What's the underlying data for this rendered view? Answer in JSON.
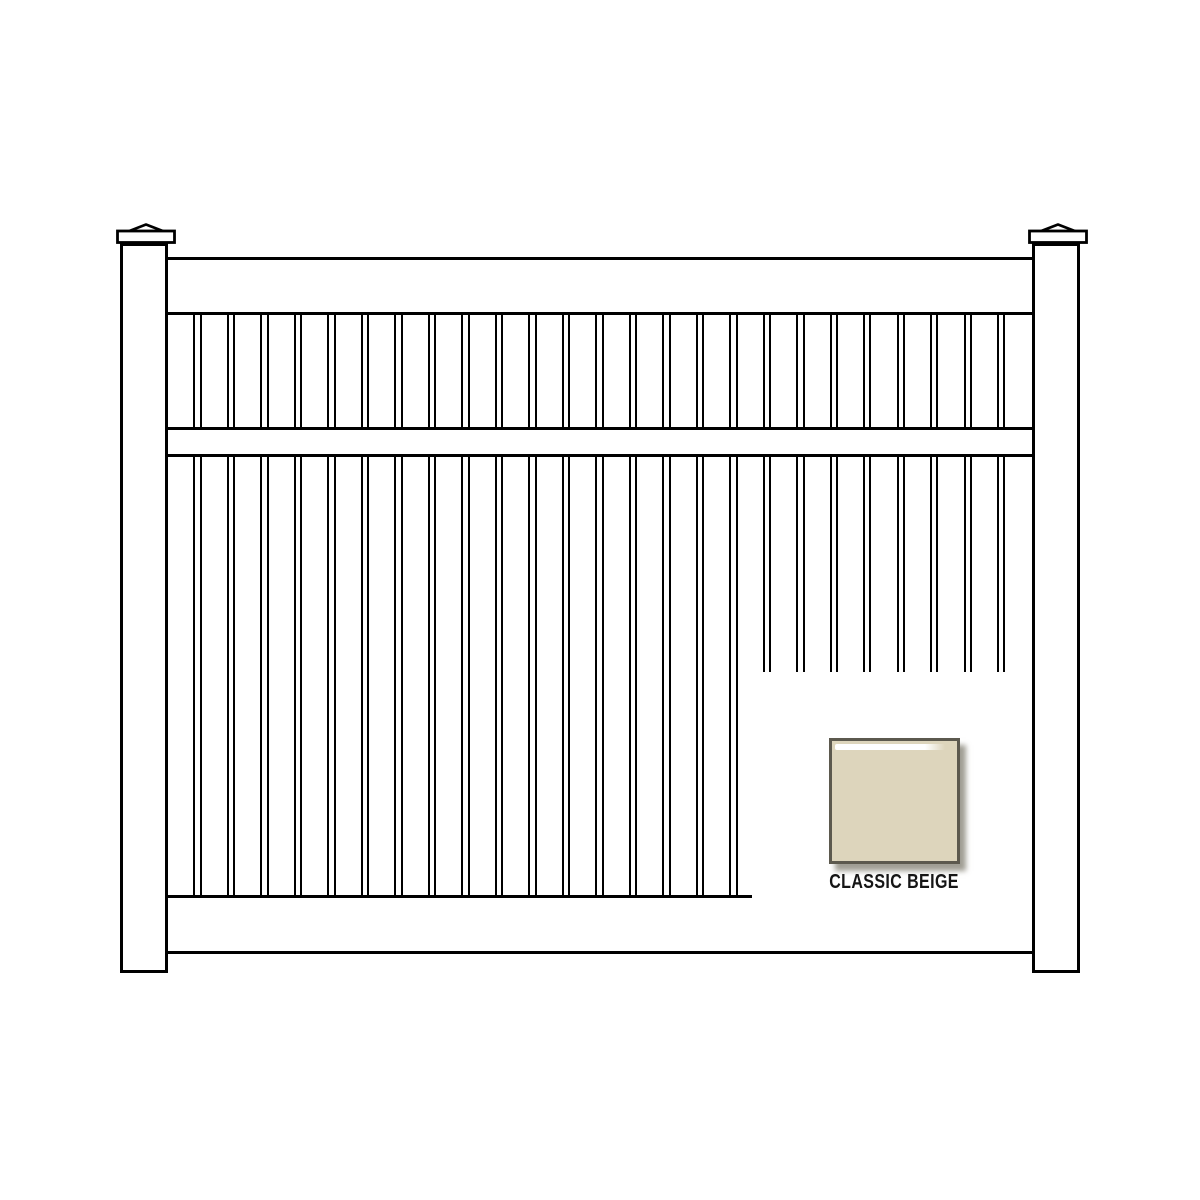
{
  "illustration": {
    "name": "vinyl-fence-panel-line-drawing",
    "background_color": "#ffffff",
    "line_color": "#000000"
  },
  "fence": {
    "post_count": 2,
    "rail_count": 3,
    "picket_count": 26,
    "picket_gap_count": 25
  },
  "swatch": {
    "label": "CLASSIC BEIGE",
    "fill_color": "#ddd5bc",
    "border_color": "#5c594e",
    "highlight_color": "#ffffff",
    "shadow_color": "rgba(128,125,112,0.75)",
    "label_color": "#151515"
  }
}
